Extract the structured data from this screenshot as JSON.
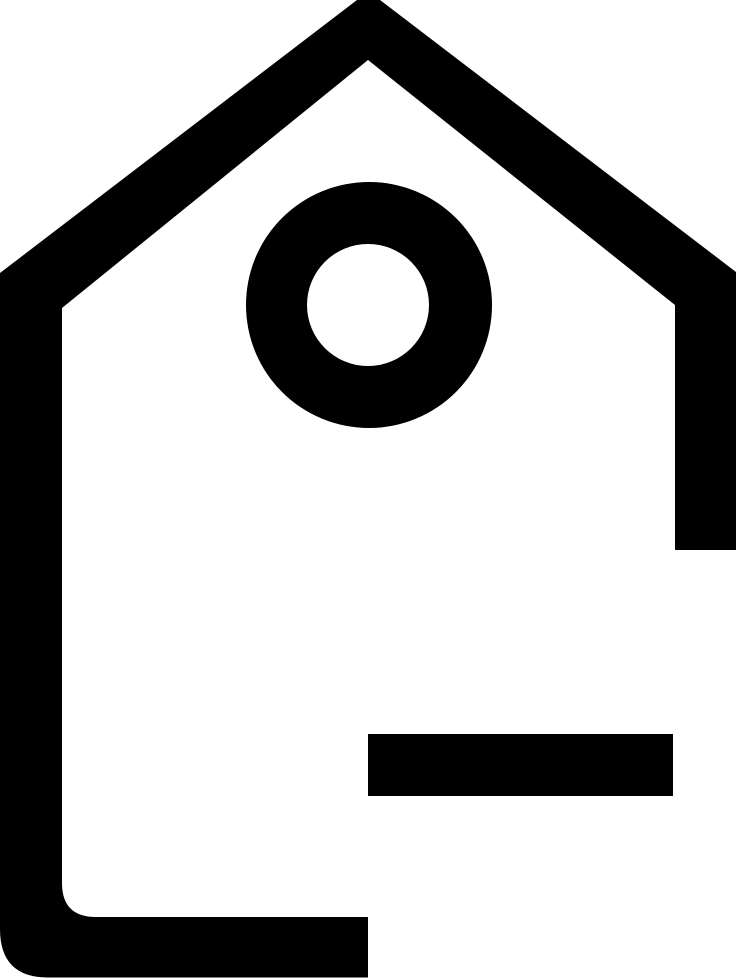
{
  "page": {
    "width_px": 736,
    "height_px": 980,
    "background_color": "#ffffff"
  },
  "icon": {
    "name": "price-tag-icon",
    "description": "Upward-pointing price tag outline with circular hole and horizontal label line",
    "color": "#000000"
  }
}
